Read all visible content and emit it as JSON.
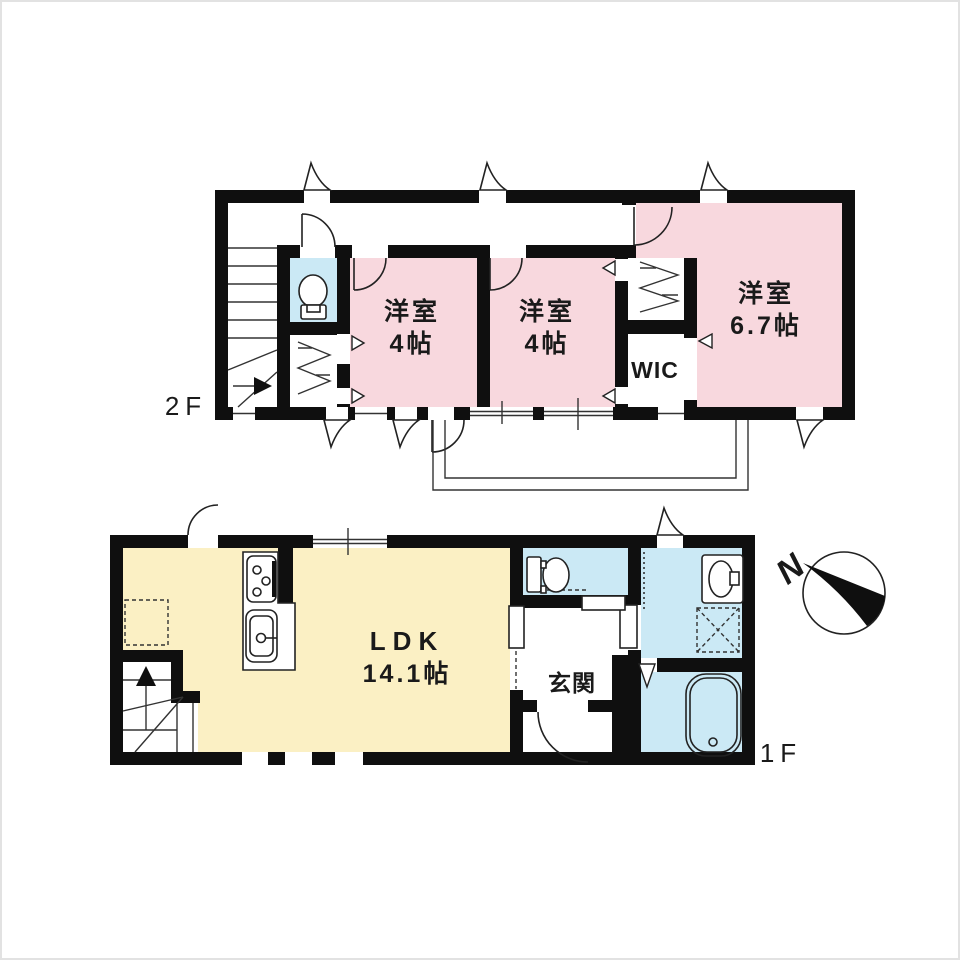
{
  "colors": {
    "wall": "#0f0f0f",
    "room_pink": "#f8d8de",
    "water_blue": "#cbe9f5",
    "ldk_yellow": "#fbf0c4",
    "line": "#333333"
  },
  "floor2": {
    "label": "2F",
    "room1": {
      "name": "洋室",
      "size": "4帖"
    },
    "room2": {
      "name": "洋室",
      "size": "4帖"
    },
    "room3": {
      "name": "洋室",
      "size": "6.7帖"
    },
    "wic": {
      "label": "WIC"
    }
  },
  "floor1": {
    "label": "1F",
    "ldk": {
      "name": "LDK",
      "size": "14.1帖"
    },
    "genkan": {
      "label": "玄関"
    }
  },
  "compass": {
    "north": "N"
  }
}
